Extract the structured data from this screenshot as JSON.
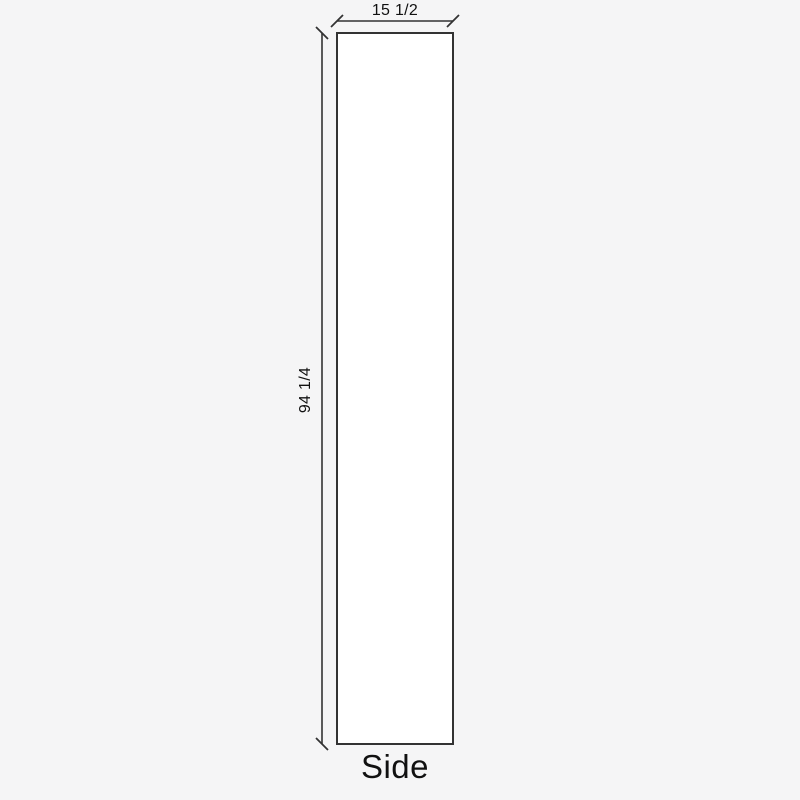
{
  "drawing": {
    "panel_label": "Side",
    "width_dimension": "15 1/2",
    "height_dimension": "94 1/4"
  },
  "colors": {
    "background": "#f5f5f6",
    "line": "#333333",
    "panel_fill": "#ffffff",
    "text": "#111111"
  }
}
